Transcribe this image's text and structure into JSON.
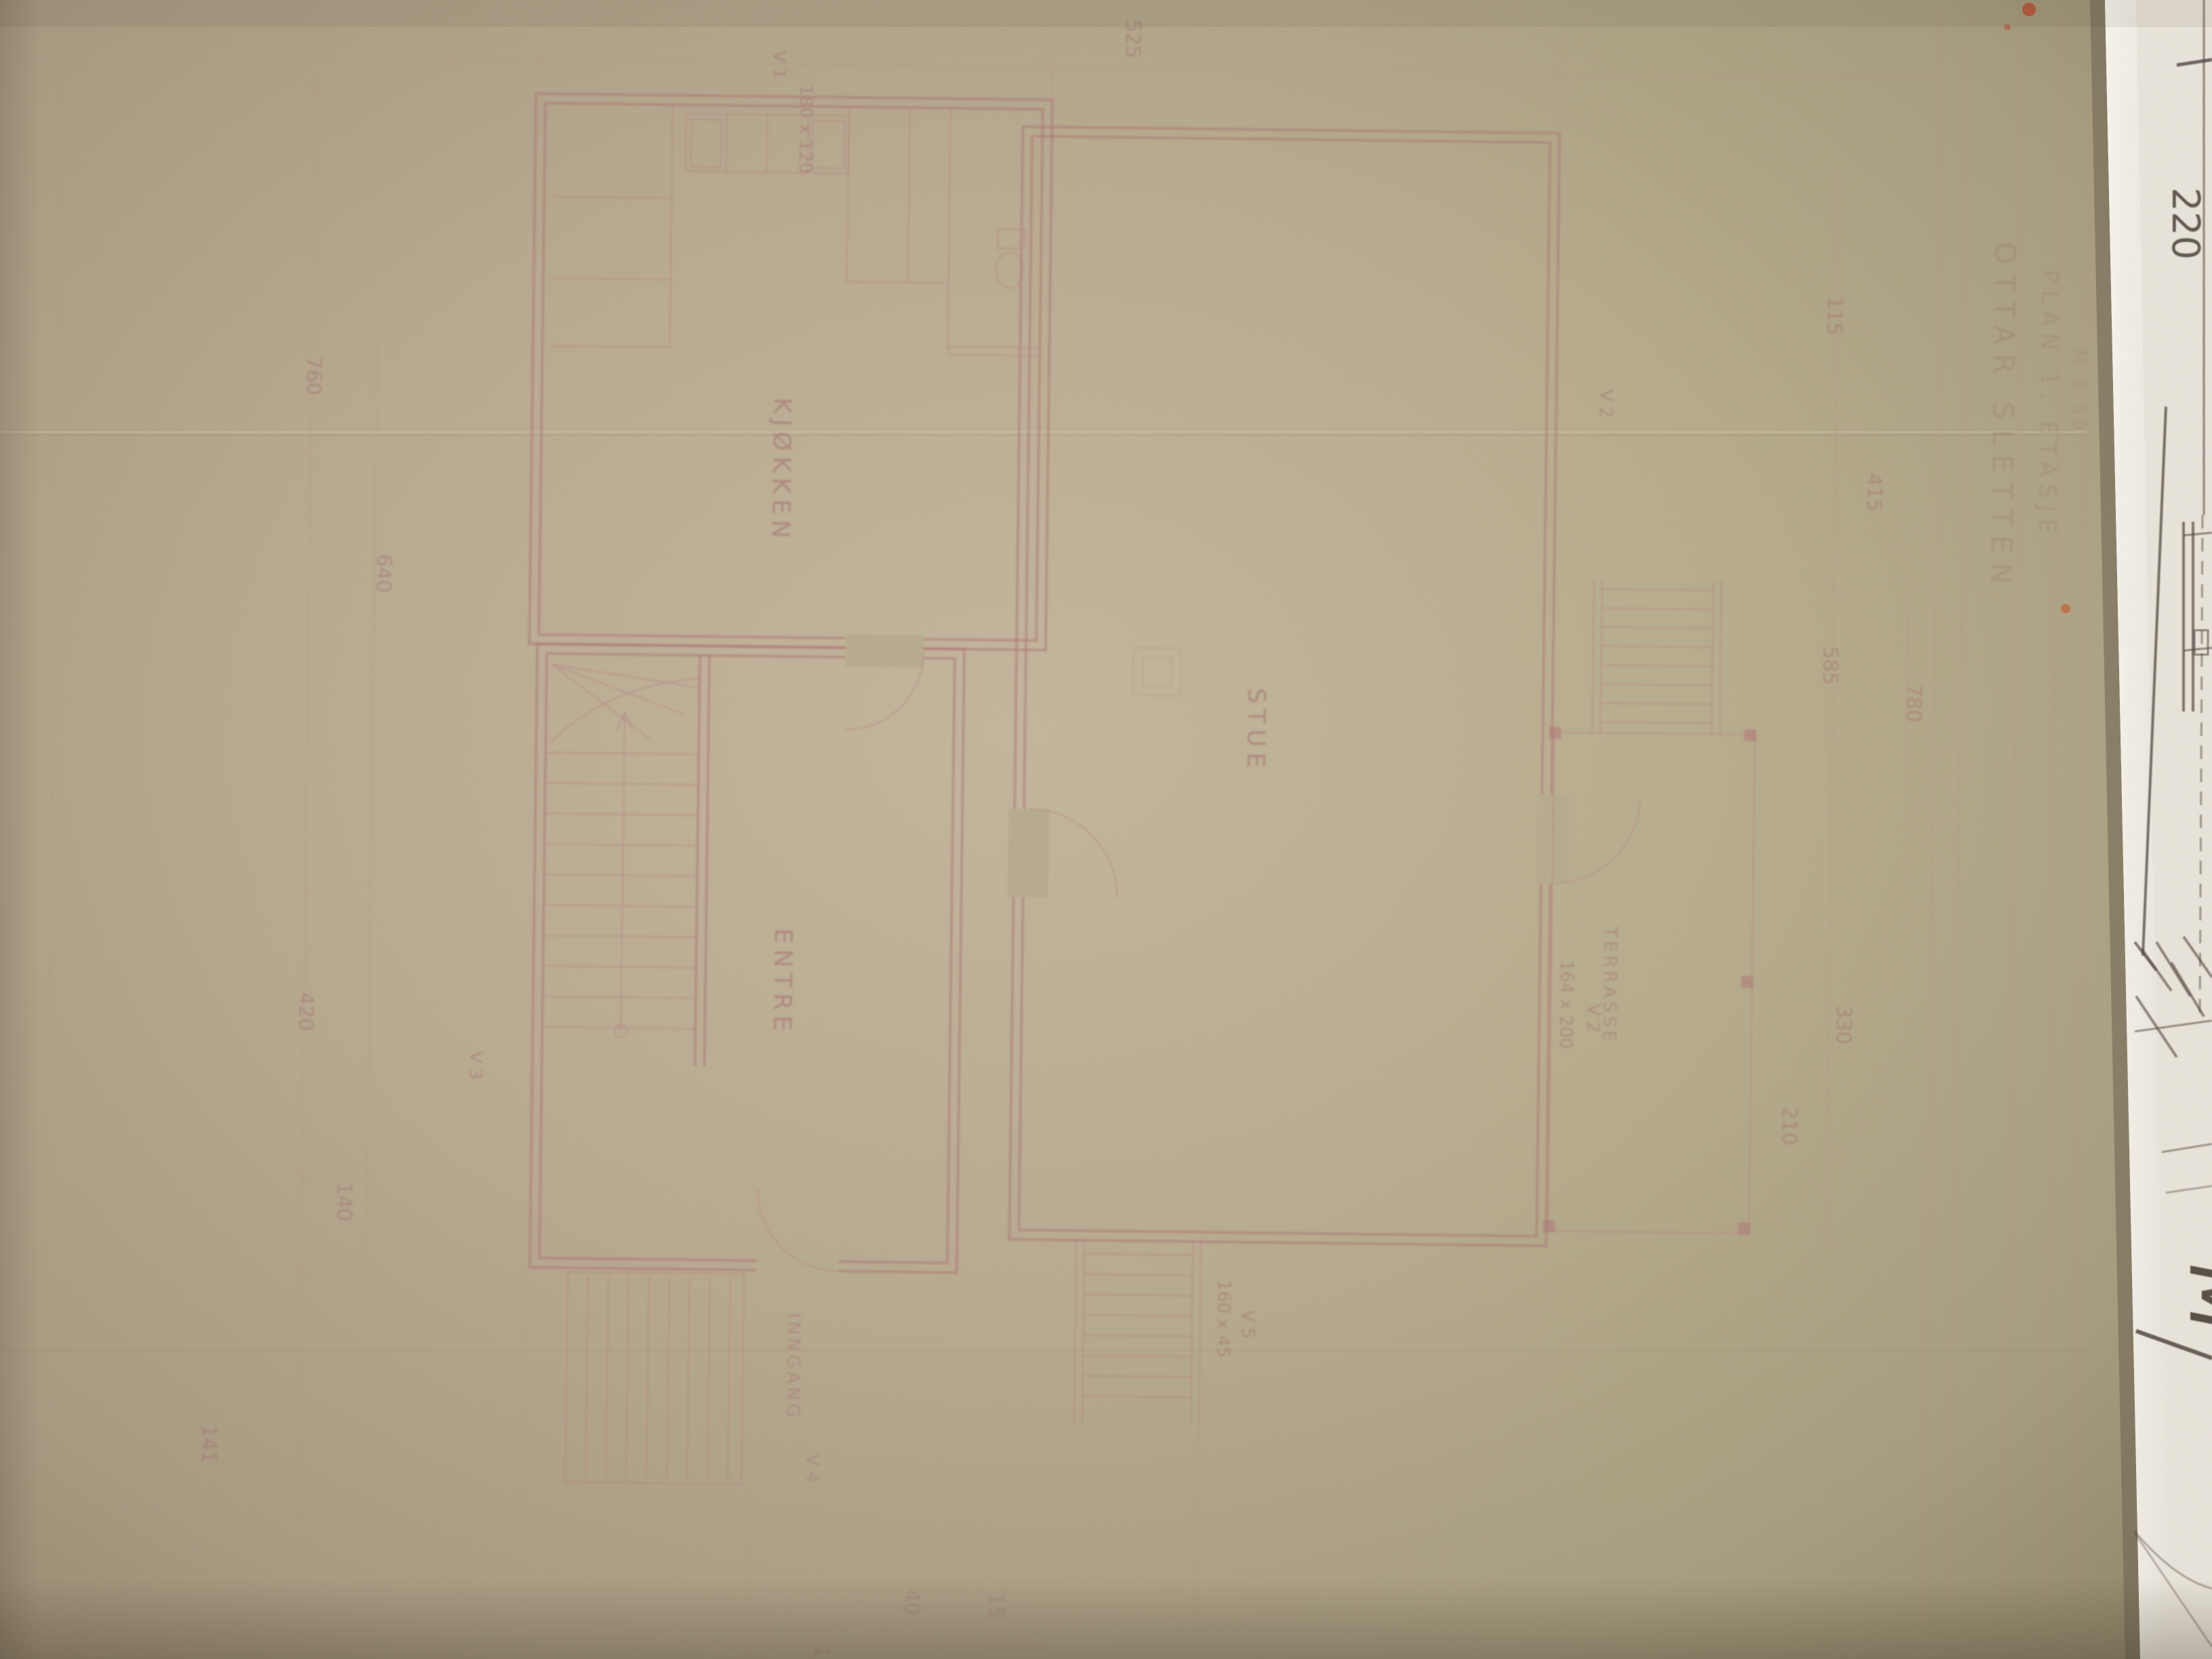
{
  "photo": {
    "subject": "photograph of hand-drafted floor plan on yellowed drafting paper, rotated 90 degrees, second white sheet visible at right edge",
    "paper_color": "#b5a98c",
    "paper_highlight": "#c8bca1",
    "paper_shadow": "#8f8468",
    "ink_color": "#b47e7e",
    "pencil_color": "#4e463d",
    "white_sheet_color": "#e9e4da"
  },
  "title_block": {
    "line1": "OTTAR SLETTEN",
    "line2": "PLAN 1. ETASJE",
    "line3": "M 1:50"
  },
  "plan": {
    "labels": {
      "kjokken": "KJØKKEN",
      "stue": "STUE",
      "entre": "ENTRE",
      "terrasse": "TERRASSE",
      "inngang": "INNGANG"
    },
    "annotations": {
      "win1_size": "180 x 120",
      "win1": "V 1",
      "win2": "V 2",
      "door_terrasse_size": "164 x 200",
      "door_terrasse": "V 2",
      "win3": "V 3",
      "win4": "V 4",
      "win5_size": "160 x 45",
      "win5": "V 5"
    },
    "dimensions": {
      "top": "525",
      "left1": "760",
      "left2": "640",
      "left3": "420",
      "left4": "140",
      "left5": "141",
      "right1": "115",
      "right2": "415",
      "right3": "585",
      "right4": "780",
      "right5": "330",
      "right6": "210",
      "bottom1": "115",
      "bottom2": "40",
      "bottom3": "15"
    }
  },
  "side_sheet": {
    "dimension": "220",
    "mark": "M"
  }
}
